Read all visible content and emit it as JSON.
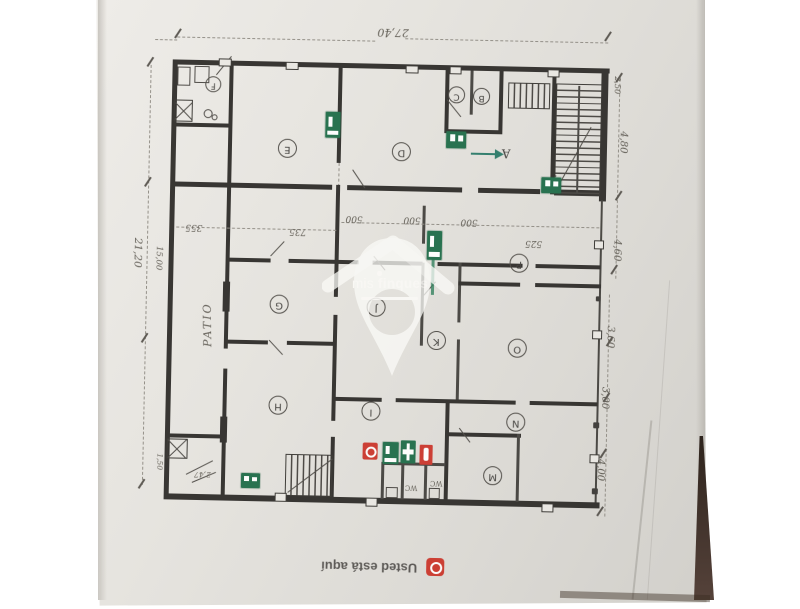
{
  "photo": {
    "background_color": "#ffffff",
    "paper_color": "#e2e0db",
    "table_edge_color": "#3a2d24"
  },
  "plan": {
    "rooms": [
      {
        "label": "E"
      },
      {
        "label": "D"
      },
      {
        "label": "C"
      },
      {
        "label": "B"
      },
      {
        "label": "F"
      },
      {
        "label": "G"
      },
      {
        "label": "J"
      },
      {
        "label": "K"
      },
      {
        "label": "P"
      },
      {
        "label": "O"
      },
      {
        "label": "H"
      },
      {
        "label": "I"
      },
      {
        "label": "N"
      },
      {
        "label": "M"
      }
    ],
    "exit_route_label": "A",
    "annotations": {
      "patio": "PATIO",
      "wc_1": "WC",
      "wc_2": "WC"
    },
    "dimensions": {
      "top": "27,40",
      "left_total": "21,20",
      "left_inner": "15,00",
      "right": [
        "2,50",
        "4,80",
        "4,60",
        "3,60",
        "3,00",
        "4,00"
      ],
      "interior": [
        "355",
        "735",
        "500",
        "500",
        "500",
        "525"
      ],
      "small": [
        "2,47",
        "1,50"
      ]
    },
    "safety_colors": {
      "green": "#1e6c48",
      "red": "#cb362b"
    },
    "safety_icons": [
      "exit-sign",
      "exit-sign",
      "exit-sign",
      "exit-sign",
      "exit-sign",
      "exit-sign",
      "first-aid-sign",
      "fire-extinguisher-sign",
      "you-are-here-marker"
    ]
  },
  "watermark": {
    "brand": "mis finques",
    "word1": "mis",
    "word2": "finques"
  },
  "legend": {
    "you_are_here": "Usted está aquí"
  }
}
